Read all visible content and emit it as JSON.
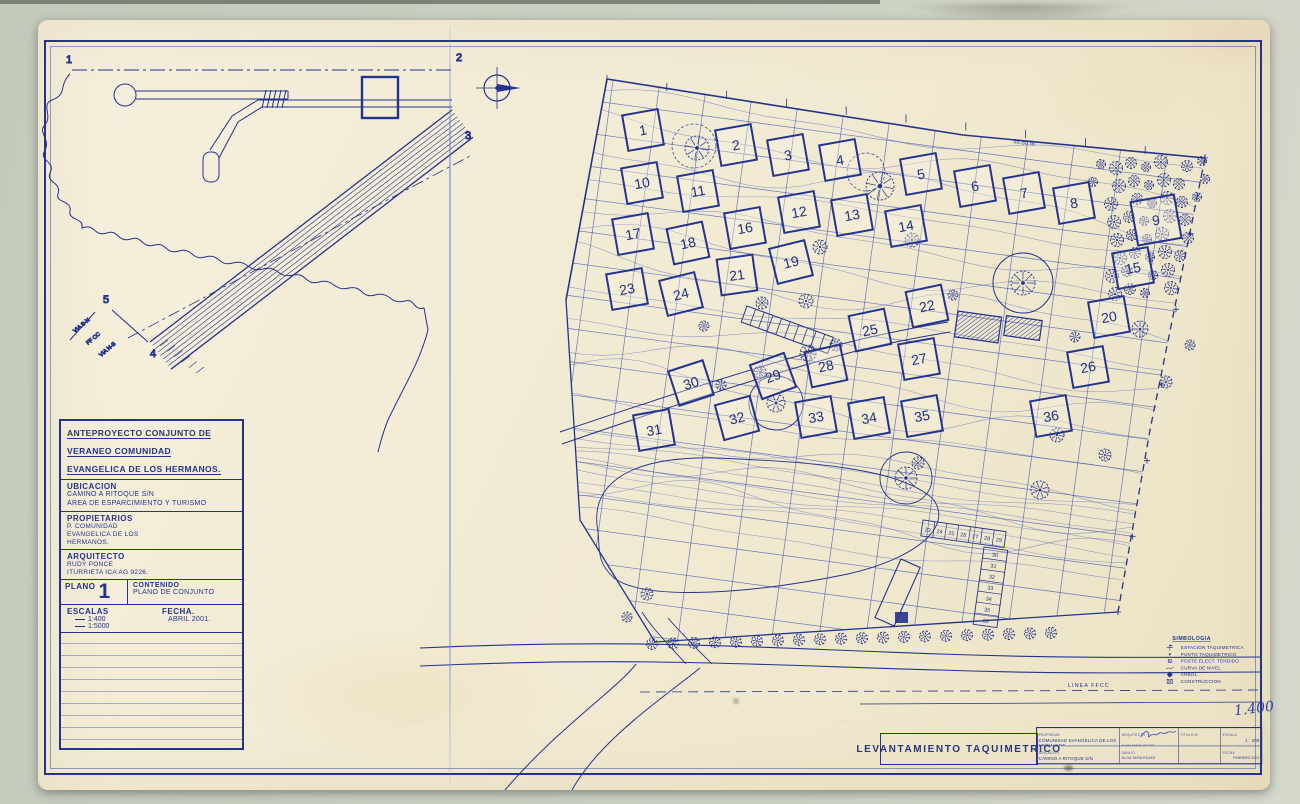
{
  "colors": {
    "ink": "#24338c",
    "ink_light": "#3a52b4",
    "paper": "#f2ebd5",
    "background": "#c9d0c2",
    "crease": "#6e8cd2"
  },
  "vicinity": {
    "points": [
      "1",
      "2",
      "3",
      "4",
      "5"
    ],
    "road_labels": [
      "VIA S-N",
      "FF CC",
      "VIA N-S"
    ]
  },
  "title_block": {
    "project_lines": [
      "ANTEPROYECTO CONJUNTO DE",
      "VERANEO COMUNIDAD",
      "EVANGELICA DE LOS HERMANOS."
    ],
    "ubicacion_label": "UBICACION",
    "ubicacion_lines": [
      "CAMINO A RITOQUE S/N",
      "AREA  DE  ESPARCIMIENTO Y TURISMO"
    ],
    "propietarios_label": "PROPIETARIOS",
    "propietarios_lines": [
      "P. COMUNIDAD",
      "EVANGELICA DE LOS",
      "HERMANOS."
    ],
    "arquitecto_label": "ARQUITECTO",
    "arquitecto_lines": [
      "RUDY PONCE",
      "ITURRIETA   ICA AG 9226."
    ],
    "plano_label": "PLANO",
    "plano_number": "1",
    "contenido_label": "CONTENIDO",
    "contenido_value": "PLANO DE CONJUNTO",
    "escalas_label": "ESCALAS",
    "escalas": [
      "1:400",
      "1:5000"
    ],
    "fecha_label": "FECHA.",
    "fecha_value": "ABRIL   2001."
  },
  "plan": {
    "lots": [
      {
        "n": "1",
        "x": 641,
        "y": 128,
        "rot": -10
      },
      {
        "n": "2",
        "x": 734,
        "y": 143,
        "rot": -10
      },
      {
        "n": "3",
        "x": 786,
        "y": 153,
        "rot": -10
      },
      {
        "n": "4",
        "x": 838,
        "y": 158,
        "rot": -10
      },
      {
        "n": "5",
        "x": 919,
        "y": 172,
        "rot": -10
      },
      {
        "n": "6",
        "x": 973,
        "y": 184,
        "rot": -10
      },
      {
        "n": "7",
        "x": 1022,
        "y": 191,
        "rot": -10
      },
      {
        "n": "8",
        "x": 1072,
        "y": 201,
        "rot": -10
      },
      {
        "n": "9",
        "x": 1154,
        "y": 218,
        "rot": -10,
        "s": 42
      },
      {
        "n": "10",
        "x": 640,
        "y": 181,
        "rot": -10
      },
      {
        "n": "11",
        "x": 696,
        "y": 189,
        "rot": -10
      },
      {
        "n": "12",
        "x": 797,
        "y": 210,
        "rot": -10
      },
      {
        "n": "13",
        "x": 850,
        "y": 213,
        "rot": -10
      },
      {
        "n": "14",
        "x": 904,
        "y": 224,
        "rot": -10
      },
      {
        "n": "15",
        "x": 1131,
        "y": 266,
        "rot": -10
      },
      {
        "n": "16",
        "x": 743,
        "y": 226,
        "rot": -10
      },
      {
        "n": "17",
        "x": 631,
        "y": 232,
        "rot": -10
      },
      {
        "n": "18",
        "x": 686,
        "y": 241,
        "rot": -12
      },
      {
        "n": "19",
        "x": 789,
        "y": 260,
        "rot": -14
      },
      {
        "n": "20",
        "x": 1107,
        "y": 315,
        "rot": -10
      },
      {
        "n": "21",
        "x": 735,
        "y": 273,
        "rot": -8
      },
      {
        "n": "22",
        "x": 925,
        "y": 304,
        "rot": -12
      },
      {
        "n": "23",
        "x": 625,
        "y": 287,
        "rot": -10
      },
      {
        "n": "24",
        "x": 679,
        "y": 292,
        "rot": -14
      },
      {
        "n": "25",
        "x": 868,
        "y": 328,
        "rot": -12
      },
      {
        "n": "26",
        "x": 1086,
        "y": 365,
        "rot": -10
      },
      {
        "n": "27",
        "x": 917,
        "y": 357,
        "rot": -10
      },
      {
        "n": "28",
        "x": 824,
        "y": 364,
        "rot": -12
      },
      {
        "n": "29",
        "x": 771,
        "y": 374,
        "rot": -20
      },
      {
        "n": "30",
        "x": 689,
        "y": 381,
        "rot": -18
      },
      {
        "n": "31",
        "x": 652,
        "y": 428,
        "rot": -10
      },
      {
        "n": "32",
        "x": 735,
        "y": 416,
        "rot": -15
      },
      {
        "n": "33",
        "x": 814,
        "y": 415,
        "rot": -10
      },
      {
        "n": "34",
        "x": 867,
        "y": 416,
        "rot": -10
      },
      {
        "n": "35",
        "x": 920,
        "y": 414,
        "rot": -10
      },
      {
        "n": "36",
        "x": 1049,
        "y": 414,
        "rot": -10
      }
    ],
    "stalls_h": [
      "23",
      "24",
      "25",
      "26",
      "27",
      "28",
      "29"
    ],
    "stalls_v": [
      "30",
      "31",
      "32",
      "33",
      "34",
      "35",
      "36"
    ],
    "dimension_label": "55.50 m",
    "railway_label": "LINEA FFCC",
    "legend": {
      "title": "SIMBOLOGIA",
      "items": [
        {
          "symbol": "station",
          "label": "ESTACION TAQUIMETRICA"
        },
        {
          "symbol": "point",
          "label": "PUNTO TAQUIMETRICO"
        },
        {
          "symbol": "pole",
          "label": "POSTE ELECT. TENDIDO"
        },
        {
          "symbol": "contour",
          "label": "CURVA DE NIVEL"
        },
        {
          "symbol": "tree",
          "label": "ARBOL"
        },
        {
          "symbol": "construction",
          "label": "CONSTRUCCION"
        }
      ]
    }
  },
  "footer": {
    "main_title": "LEVANTAMIENTO   TAQUIMETRICO",
    "handwritten_scale": "1.400",
    "table": {
      "col1": [
        {
          "label": "PROPIEDAD",
          "value": "COMUNIDAD EVANGELICA DE LOS HERMANOS"
        },
        {
          "label": "UBICACION",
          "value": "CAMINO A RITOQUE  S/N"
        }
      ],
      "col2": [
        {
          "label": "ARQUITECTO",
          "value": "JUAN TAPIA ROJAS"
        },
        {
          "label": "DIBUJO",
          "value": "OLGA TAPIA ROJAS"
        }
      ],
      "col3": [
        {
          "label": "TITULO  Nº",
          "value": ""
        },
        {
          "label": "",
          "value": ""
        }
      ],
      "col4": [
        {
          "label": "ESCALA",
          "value": "1 : 200"
        },
        {
          "label": "FECHA",
          "value": "FEBRERO 2001"
        }
      ]
    }
  }
}
